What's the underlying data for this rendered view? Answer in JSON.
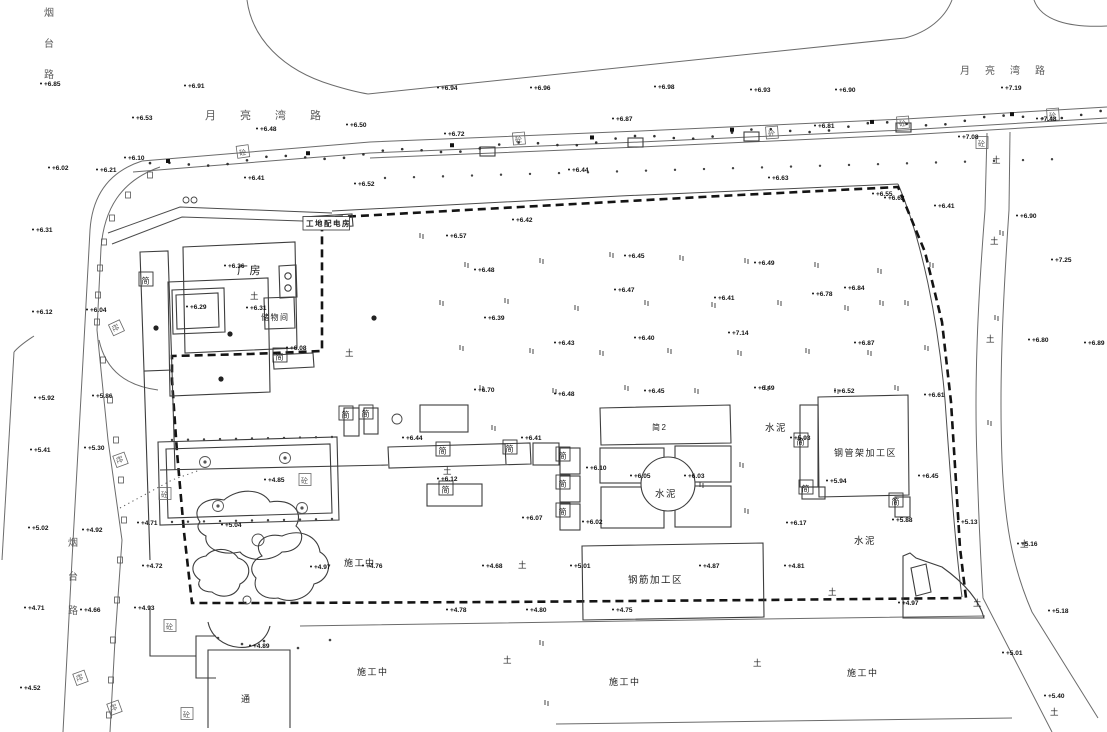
{
  "canvas": {
    "width": 1107,
    "height": 732,
    "background": "#ffffff",
    "line_color": "#6b6b6b",
    "building_color": "#3d3d3d",
    "boundary_color": "#141414",
    "text_color": "#222222"
  },
  "road_names": [
    {
      "name": "top-road-name-west",
      "text": "月亮湾路",
      "x": 205,
      "y": 119,
      "spacing": 35,
      "vertical": false,
      "size": 11
    },
    {
      "name": "top-road-name-east",
      "text": "月亮湾路",
      "x": 960,
      "y": 74,
      "spacing": 25,
      "vertical": false,
      "size": 10
    },
    {
      "name": "left-road-name-top",
      "text": "烟台路",
      "x": 44,
      "y": 16,
      "spacing": 31,
      "vertical": true,
      "size": 10
    },
    {
      "name": "left-road-name-mid",
      "text": "烟台路",
      "x": 68,
      "y": 546,
      "spacing": 34,
      "vertical": true,
      "size": 10
    }
  ],
  "area_labels": [
    {
      "name": "factory-label",
      "text": "厂房",
      "x": 237,
      "y": 274,
      "size": 11,
      "boxed": false
    },
    {
      "name": "storage-room-label",
      "text": "储物间",
      "x": 261,
      "y": 320,
      "size": 8,
      "boxed": false
    },
    {
      "name": "site-office-label",
      "text": "工地配电房",
      "x": 306,
      "y": 226,
      "size": 7.5,
      "boxed": true
    },
    {
      "name": "shed2-label",
      "text": "简2",
      "x": 652,
      "y": 430,
      "size": 8,
      "boxed": false
    },
    {
      "name": "cement-label-center",
      "text": "水泥",
      "x": 655,
      "y": 497,
      "size": 9.5,
      "boxed": false
    },
    {
      "name": "cement-label-right",
      "text": "水泥",
      "x": 765,
      "y": 431,
      "size": 9.5,
      "boxed": false
    },
    {
      "name": "cement-label-bottom",
      "text": "水泥",
      "x": 854,
      "y": 544,
      "size": 9.5,
      "boxed": false
    },
    {
      "name": "steel-pipe-area-label",
      "text": "钢管架加工区",
      "x": 834,
      "y": 456,
      "size": 9,
      "boxed": false
    },
    {
      "name": "rebar-area-label",
      "text": "钢筋加工区",
      "x": 628,
      "y": 583,
      "size": 9.5,
      "boxed": false
    },
    {
      "name": "under-construction-label-1",
      "text": "施工中",
      "x": 344,
      "y": 566,
      "size": 9,
      "boxed": false
    },
    {
      "name": "under-construction-label-2",
      "text": "施工中",
      "x": 357,
      "y": 675,
      "size": 9,
      "boxed": false
    },
    {
      "name": "under-construction-label-3",
      "text": "施工中",
      "x": 609,
      "y": 685,
      "size": 9,
      "boxed": false
    },
    {
      "name": "under-construction-label-4",
      "text": "施工中",
      "x": 847,
      "y": 676,
      "size": 9,
      "boxed": false
    },
    {
      "name": "passage-label",
      "text": "通",
      "x": 241,
      "y": 702,
      "size": 9,
      "boxed": false
    }
  ],
  "shed_label_char": "简",
  "shed_boxes": [
    {
      "x": 146,
      "y": 280
    },
    {
      "x": 346,
      "y": 414
    },
    {
      "x": 366,
      "y": 413
    },
    {
      "x": 443,
      "y": 450
    },
    {
      "x": 510,
      "y": 448
    },
    {
      "x": 563,
      "y": 455
    },
    {
      "x": 563,
      "y": 483
    },
    {
      "x": 563,
      "y": 511
    },
    {
      "x": 801,
      "y": 441
    },
    {
      "x": 806,
      "y": 488
    },
    {
      "x": 896,
      "y": 501
    },
    {
      "x": 446,
      "y": 489
    },
    {
      "x": 280,
      "y": 356
    }
  ],
  "concrete_label_char": "砼",
  "concrete_boxes": [
    {
      "x": 243,
      "y": 152,
      "rot": -8
    },
    {
      "x": 519,
      "y": 139,
      "rot": -5
    },
    {
      "x": 772,
      "y": 133,
      "rot": -4
    },
    {
      "x": 903,
      "y": 123,
      "rot": -4
    },
    {
      "x": 1053,
      "y": 115,
      "rot": -4
    },
    {
      "x": 982,
      "y": 143,
      "rot": 0
    },
    {
      "x": 116,
      "y": 328,
      "rot": 65
    },
    {
      "x": 120,
      "y": 460,
      "rot": 70
    },
    {
      "x": 80,
      "y": 678,
      "rot": 70
    },
    {
      "x": 114,
      "y": 708,
      "rot": 70
    },
    {
      "x": 170,
      "y": 626,
      "rot": 0
    },
    {
      "x": 187,
      "y": 714,
      "rot": 0
    },
    {
      "x": 305,
      "y": 480,
      "rot": 0
    },
    {
      "x": 165,
      "y": 494,
      "rot": 0
    }
  ],
  "soil_mark_char": "土",
  "soil_marks": [
    {
      "x": 250,
      "y": 299
    },
    {
      "x": 345,
      "y": 356
    },
    {
      "x": 443,
      "y": 474
    },
    {
      "x": 518,
      "y": 568
    },
    {
      "x": 503,
      "y": 663
    },
    {
      "x": 753,
      "y": 666
    },
    {
      "x": 828,
      "y": 595
    },
    {
      "x": 992,
      "y": 163
    },
    {
      "x": 990,
      "y": 244
    },
    {
      "x": 986,
      "y": 342
    },
    {
      "x": 973,
      "y": 606
    },
    {
      "x": 1050,
      "y": 715
    },
    {
      "x": 1020,
      "y": 547
    }
  ],
  "grass_marks": [
    {
      "x": 420,
      "y": 233
    },
    {
      "x": 465,
      "y": 262
    },
    {
      "x": 540,
      "y": 258
    },
    {
      "x": 610,
      "y": 252
    },
    {
      "x": 680,
      "y": 255
    },
    {
      "x": 745,
      "y": 258
    },
    {
      "x": 815,
      "y": 262
    },
    {
      "x": 878,
      "y": 268
    },
    {
      "x": 930,
      "y": 262
    },
    {
      "x": 440,
      "y": 300
    },
    {
      "x": 505,
      "y": 298
    },
    {
      "x": 575,
      "y": 305
    },
    {
      "x": 645,
      "y": 300
    },
    {
      "x": 712,
      "y": 302
    },
    {
      "x": 778,
      "y": 300
    },
    {
      "x": 845,
      "y": 305
    },
    {
      "x": 905,
      "y": 300
    },
    {
      "x": 460,
      "y": 345
    },
    {
      "x": 530,
      "y": 348
    },
    {
      "x": 600,
      "y": 350
    },
    {
      "x": 668,
      "y": 348
    },
    {
      "x": 738,
      "y": 350
    },
    {
      "x": 806,
      "y": 348
    },
    {
      "x": 868,
      "y": 350
    },
    {
      "x": 925,
      "y": 345
    },
    {
      "x": 480,
      "y": 385
    },
    {
      "x": 553,
      "y": 388
    },
    {
      "x": 625,
      "y": 385
    },
    {
      "x": 695,
      "y": 388
    },
    {
      "x": 765,
      "y": 385
    },
    {
      "x": 835,
      "y": 388
    },
    {
      "x": 895,
      "y": 385
    },
    {
      "x": 492,
      "y": 425
    },
    {
      "x": 740,
      "y": 462
    },
    {
      "x": 700,
      "y": 482
    },
    {
      "x": 745,
      "y": 508
    },
    {
      "x": 545,
      "y": 700
    },
    {
      "x": 1000,
      "y": 230
    },
    {
      "x": 995,
      "y": 315
    },
    {
      "x": 988,
      "y": 420
    },
    {
      "x": 540,
      "y": 640
    },
    {
      "x": 880,
      "y": 300
    }
  ],
  "elevation_points": [
    {
      "x": 44,
      "y": 86,
      "v": "+6.85"
    },
    {
      "x": 188,
      "y": 88,
      "v": "+6.91"
    },
    {
      "x": 441,
      "y": 90,
      "v": "+6.94"
    },
    {
      "x": 534,
      "y": 90,
      "v": "+6.96"
    },
    {
      "x": 658,
      "y": 89,
      "v": "+6.98"
    },
    {
      "x": 754,
      "y": 92,
      "v": "+6.93"
    },
    {
      "x": 839,
      "y": 92,
      "v": "+6.90"
    },
    {
      "x": 1005,
      "y": 90,
      "v": "+7.19"
    },
    {
      "x": 136,
      "y": 120,
      "v": "+6.53"
    },
    {
      "x": 260,
      "y": 131,
      "v": "+6.48"
    },
    {
      "x": 350,
      "y": 127,
      "v": "+6.50"
    },
    {
      "x": 448,
      "y": 136,
      "v": "+6.72"
    },
    {
      "x": 616,
      "y": 121,
      "v": "+6.87"
    },
    {
      "x": 818,
      "y": 128,
      "v": "+6.81"
    },
    {
      "x": 962,
      "y": 139,
      "v": "+7.08"
    },
    {
      "x": 1040,
      "y": 121,
      "v": "+7.48"
    },
    {
      "x": 128,
      "y": 160,
      "v": "+6.10"
    },
    {
      "x": 100,
      "y": 172,
      "v": "+6.21"
    },
    {
      "x": 52,
      "y": 170,
      "v": "+6.02"
    },
    {
      "x": 248,
      "y": 180,
      "v": "+6.41"
    },
    {
      "x": 358,
      "y": 186,
      "v": "+6.52"
    },
    {
      "x": 572,
      "y": 172,
      "v": "+6.44"
    },
    {
      "x": 772,
      "y": 180,
      "v": "+6.63"
    },
    {
      "x": 876,
      "y": 196,
      "v": "+6.55"
    },
    {
      "x": 36,
      "y": 232,
      "v": "+6.31"
    },
    {
      "x": 90,
      "y": 312,
      "v": "+6.04"
    },
    {
      "x": 36,
      "y": 314,
      "v": "+6.12"
    },
    {
      "x": 96,
      "y": 398,
      "v": "+5.86"
    },
    {
      "x": 38,
      "y": 400,
      "v": "+5.92"
    },
    {
      "x": 88,
      "y": 450,
      "v": "+5.30"
    },
    {
      "x": 34,
      "y": 452,
      "v": "+5.41"
    },
    {
      "x": 86,
      "y": 532,
      "v": "+4.92"
    },
    {
      "x": 32,
      "y": 530,
      "v": "+5.02"
    },
    {
      "x": 84,
      "y": 612,
      "v": "+4.66"
    },
    {
      "x": 28,
      "y": 610,
      "v": "+4.71"
    },
    {
      "x": 24,
      "y": 690,
      "v": "+4.52"
    },
    {
      "x": 516,
      "y": 222,
      "v": "+6.42"
    },
    {
      "x": 450,
      "y": 238,
      "v": "+6.57"
    },
    {
      "x": 478,
      "y": 272,
      "v": "+6.48"
    },
    {
      "x": 628,
      "y": 258,
      "v": "+6.45"
    },
    {
      "x": 758,
      "y": 265,
      "v": "+6.49"
    },
    {
      "x": 848,
      "y": 290,
      "v": "+6.84"
    },
    {
      "x": 618,
      "y": 292,
      "v": "+6.47"
    },
    {
      "x": 718,
      "y": 300,
      "v": "+6.41"
    },
    {
      "x": 816,
      "y": 296,
      "v": "+6.78"
    },
    {
      "x": 888,
      "y": 200,
      "v": "+6.62"
    },
    {
      "x": 938,
      "y": 208,
      "v": "+6.41"
    },
    {
      "x": 1020,
      "y": 218,
      "v": "+6.90"
    },
    {
      "x": 1055,
      "y": 262,
      "v": "+7.25"
    },
    {
      "x": 488,
      "y": 320,
      "v": "+6.39"
    },
    {
      "x": 558,
      "y": 345,
      "v": "+6.43"
    },
    {
      "x": 638,
      "y": 340,
      "v": "+6.40"
    },
    {
      "x": 732,
      "y": 335,
      "v": "+7.14"
    },
    {
      "x": 858,
      "y": 345,
      "v": "+6.87"
    },
    {
      "x": 1032,
      "y": 342,
      "v": "+6.80"
    },
    {
      "x": 1088,
      "y": 345,
      "v": "+6.89"
    },
    {
      "x": 478,
      "y": 392,
      "v": "+6.70"
    },
    {
      "x": 558,
      "y": 396,
      "v": "+6.48"
    },
    {
      "x": 648,
      "y": 393,
      "v": "+6.45"
    },
    {
      "x": 758,
      "y": 390,
      "v": "+6.49"
    },
    {
      "x": 838,
      "y": 393,
      "v": "+6.52"
    },
    {
      "x": 928,
      "y": 397,
      "v": "+6.61"
    },
    {
      "x": 228,
      "y": 268,
      "v": "+6.36"
    },
    {
      "x": 250,
      "y": 310,
      "v": "+6.31"
    },
    {
      "x": 190,
      "y": 309,
      "v": "+6.29"
    },
    {
      "x": 290,
      "y": 350,
      "v": "+6.08"
    },
    {
      "x": 406,
      "y": 440,
      "v": "+6.44"
    },
    {
      "x": 525,
      "y": 440,
      "v": "+6.41"
    },
    {
      "x": 590,
      "y": 470,
      "v": "+6.10"
    },
    {
      "x": 634,
      "y": 478,
      "v": "+6.05"
    },
    {
      "x": 688,
      "y": 478,
      "v": "+6.03"
    },
    {
      "x": 441,
      "y": 481,
      "v": "+6.12"
    },
    {
      "x": 526,
      "y": 520,
      "v": "+6.07"
    },
    {
      "x": 586,
      "y": 524,
      "v": "+6.02"
    },
    {
      "x": 794,
      "y": 440,
      "v": "+5.93"
    },
    {
      "x": 830,
      "y": 483,
      "v": "+5.94"
    },
    {
      "x": 922,
      "y": 478,
      "v": "+6.45"
    },
    {
      "x": 896,
      "y": 522,
      "v": "+5.88"
    },
    {
      "x": 790,
      "y": 525,
      "v": "+6.17"
    },
    {
      "x": 268,
      "y": 482,
      "v": "+4.85"
    },
    {
      "x": 141,
      "y": 525,
      "v": "+4.71"
    },
    {
      "x": 225,
      "y": 527,
      "v": "+5.04"
    },
    {
      "x": 314,
      "y": 569,
      "v": "+4.97"
    },
    {
      "x": 138,
      "y": 610,
      "v": "+4.93"
    },
    {
      "x": 253,
      "y": 648,
      "v": "+4.89"
    },
    {
      "x": 366,
      "y": 568,
      "v": "+4.76"
    },
    {
      "x": 486,
      "y": 568,
      "v": "+4.68"
    },
    {
      "x": 574,
      "y": 568,
      "v": "+5.01"
    },
    {
      "x": 703,
      "y": 568,
      "v": "+4.87"
    },
    {
      "x": 788,
      "y": 568,
      "v": "+4.81"
    },
    {
      "x": 450,
      "y": 612,
      "v": "+4.78"
    },
    {
      "x": 530,
      "y": 612,
      "v": "+4.80"
    },
    {
      "x": 616,
      "y": 612,
      "v": "+4.75"
    },
    {
      "x": 146,
      "y": 568,
      "v": "+4.72"
    },
    {
      "x": 961,
      "y": 524,
      "v": "+5.13"
    },
    {
      "x": 1021,
      "y": 546,
      "v": "+5.16"
    },
    {
      "x": 1052,
      "y": 613,
      "v": "+5.18"
    },
    {
      "x": 1006,
      "y": 655,
      "v": "+5.01"
    },
    {
      "x": 1048,
      "y": 698,
      "v": "+5.40"
    },
    {
      "x": 902,
      "y": 605,
      "v": "+4.97"
    }
  ],
  "garden_trees": [
    {
      "x": 205,
      "y": 462
    },
    {
      "x": 285,
      "y": 458
    },
    {
      "x": 218,
      "y": 506
    },
    {
      "x": 302,
      "y": 508
    }
  ],
  "tree_dots": [
    {
      "x": 230,
      "y": 334
    },
    {
      "x": 221,
      "y": 379
    },
    {
      "x": 374,
      "y": 318
    },
    {
      "x": 156,
      "y": 328
    }
  ],
  "open_circles": [
    {
      "x": 186,
      "y": 200,
      "r": 3
    },
    {
      "x": 194,
      "y": 200,
      "r": 3
    },
    {
      "x": 397,
      "y": 419,
      "r": 5
    },
    {
      "x": 258,
      "y": 540,
      "r": 6
    },
    {
      "x": 247,
      "y": 600,
      "r": 4
    }
  ]
}
